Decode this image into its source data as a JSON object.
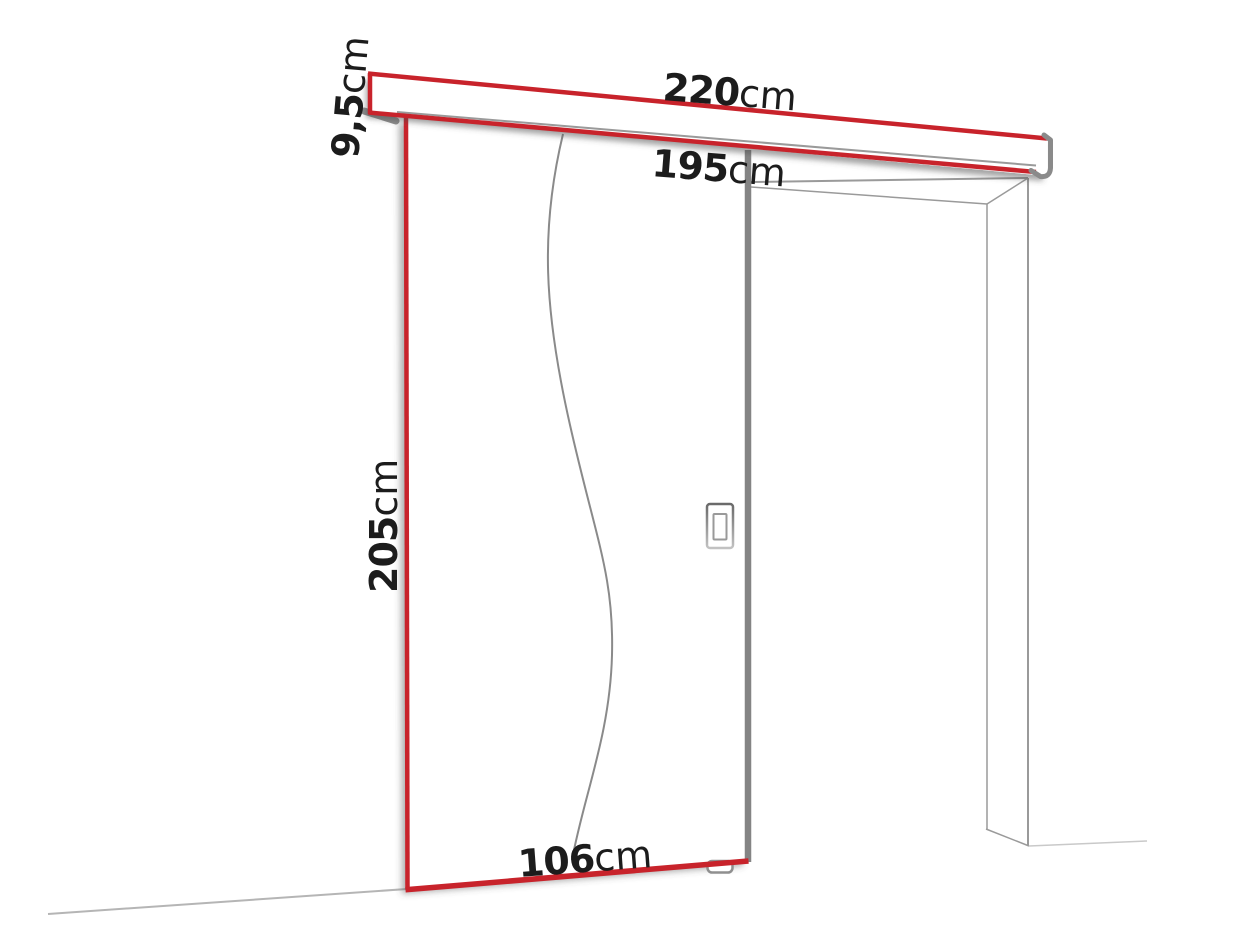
{
  "diagram": {
    "type": "sliding-door-installation-dimension-diagram",
    "units": "cm",
    "dimensions": {
      "rail_length": {
        "value": "220",
        "unit": "cm"
      },
      "opening_width": {
        "value": "195",
        "unit": "cm"
      },
      "rail_height": {
        "value": "9,5",
        "unit": "cm"
      },
      "door_height": {
        "value": "205",
        "unit": "cm"
      },
      "door_width": {
        "value": "106",
        "unit": "cm"
      }
    },
    "colors": {
      "dimension_line_red": "#c8232b",
      "door_edge_gray": "#848484",
      "frame_line_gray": "#9a9a9a",
      "text_color": "#1c1c1c",
      "background": "#ffffff"
    }
  }
}
